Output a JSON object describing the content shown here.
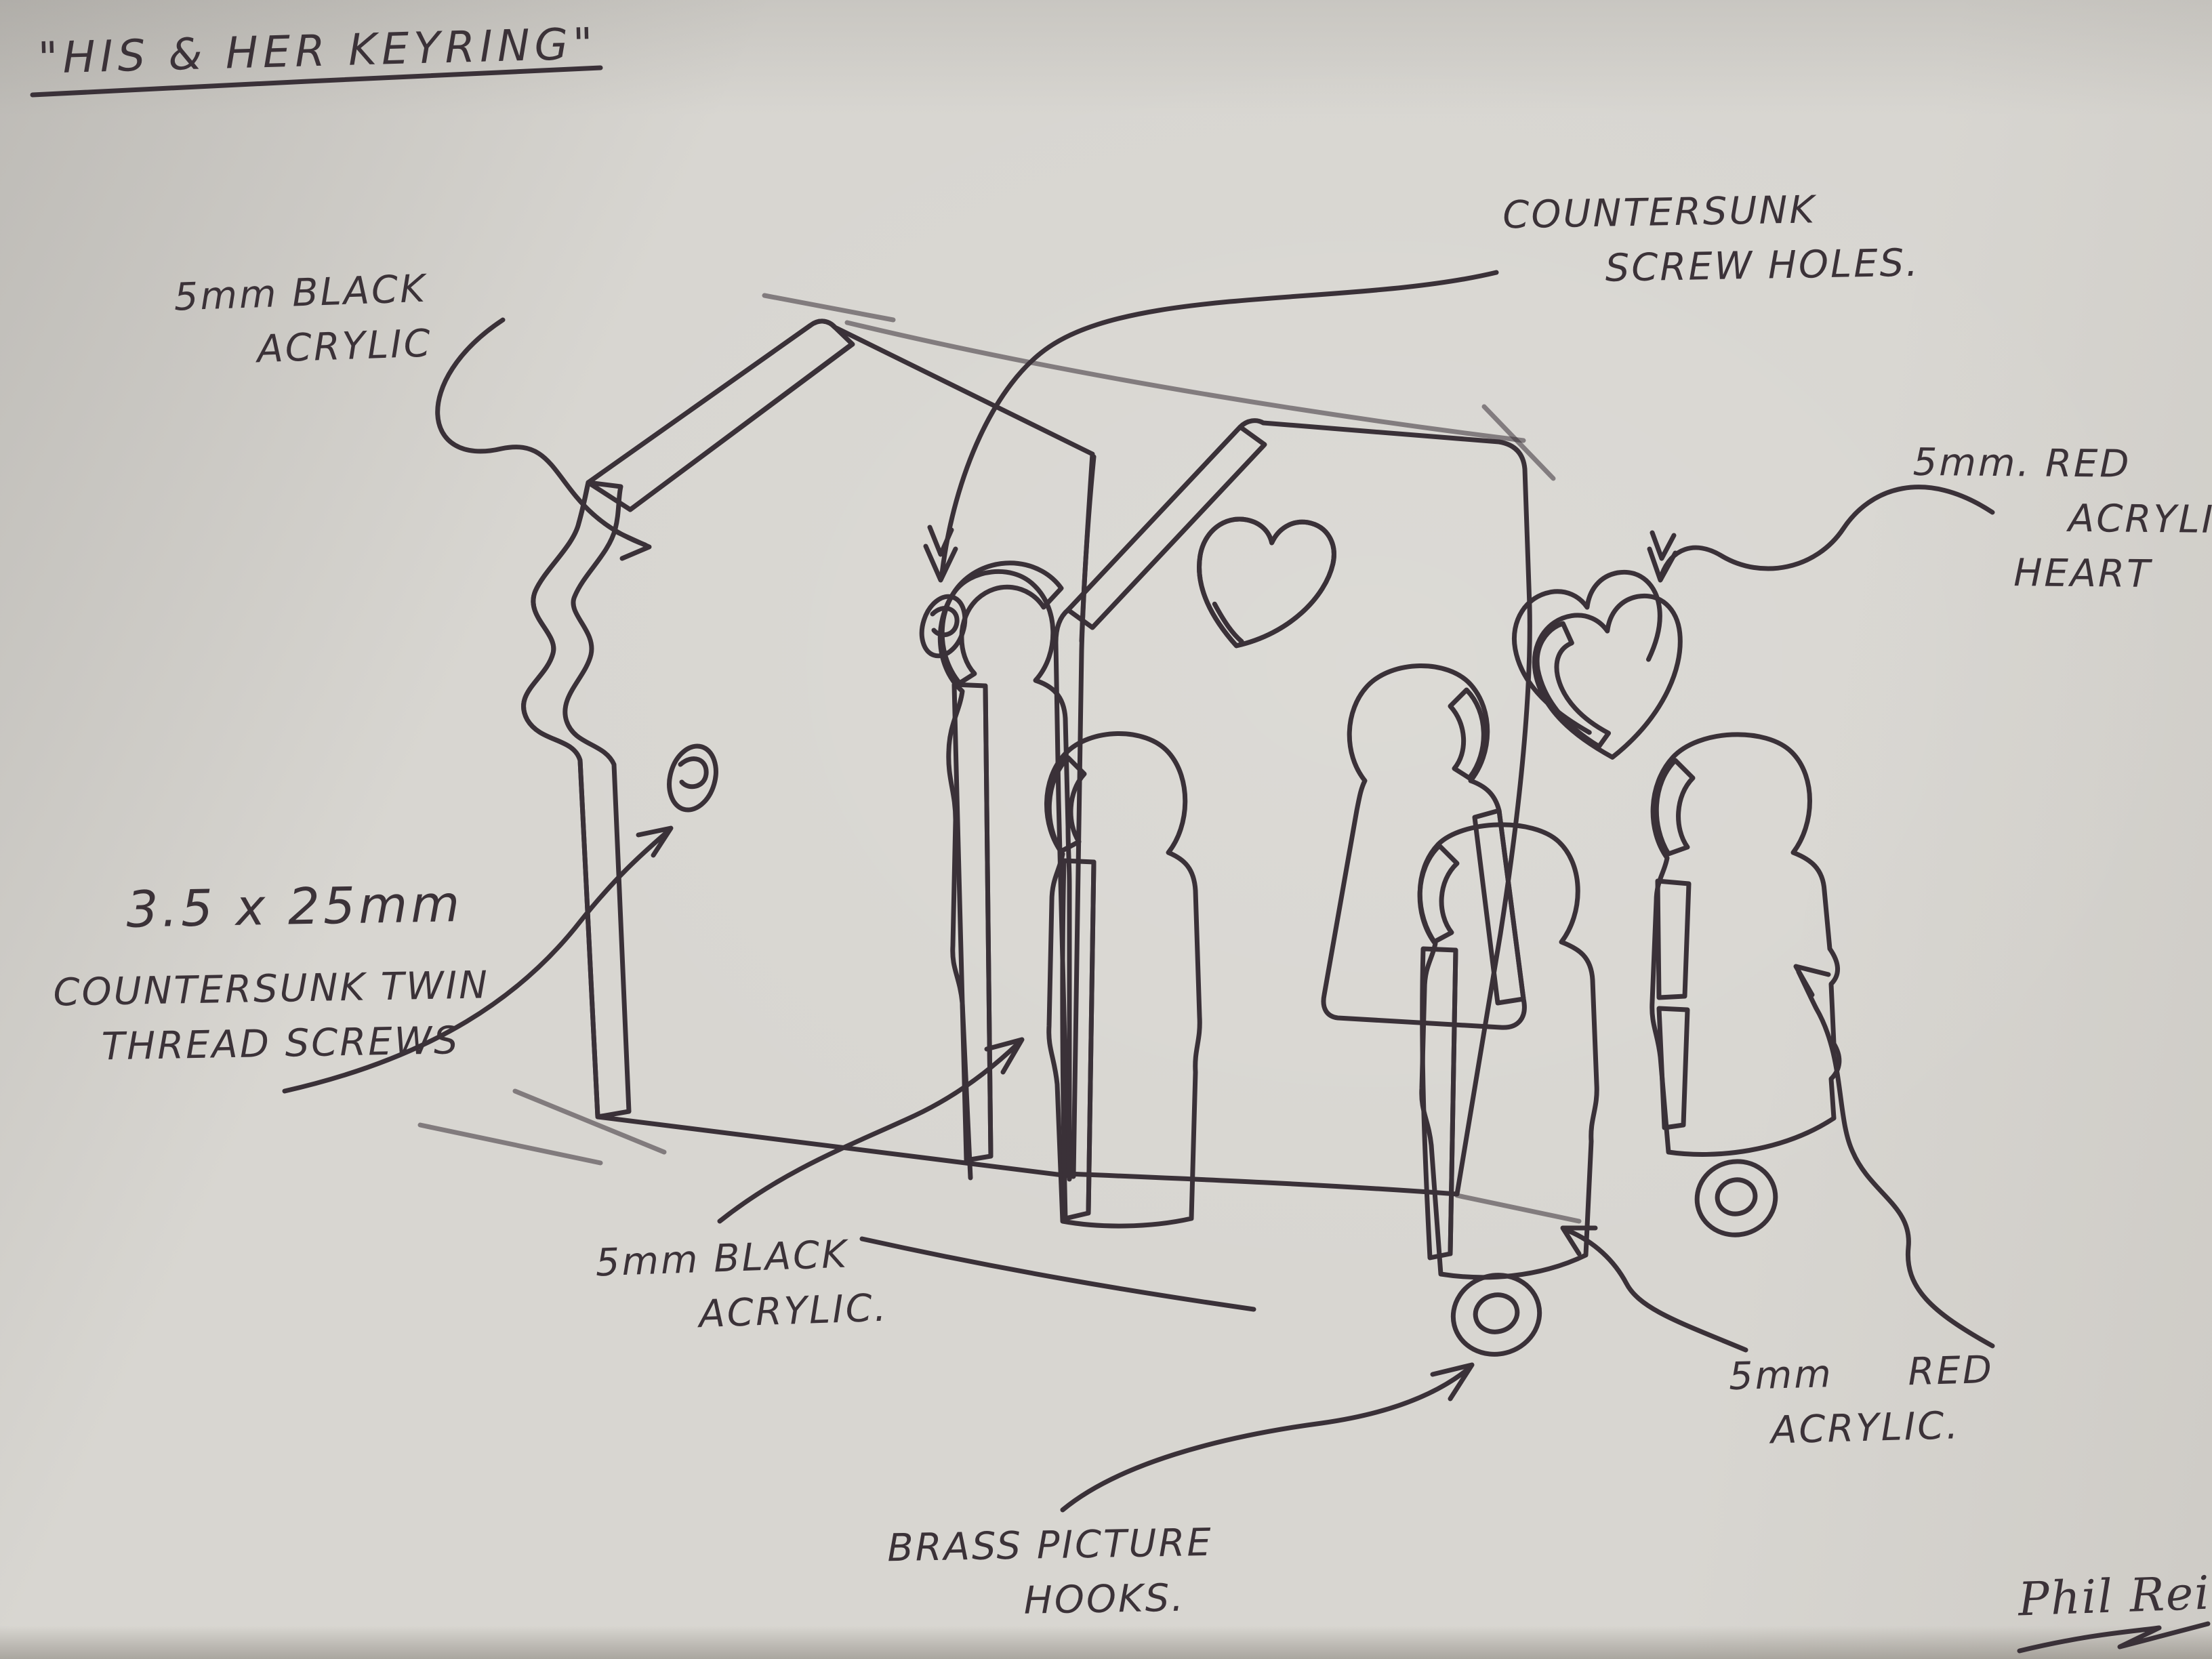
{
  "title": {
    "text": "\"HIS & HER KEYRING\""
  },
  "labels": {
    "black_acrylic_top": {
      "lines": [
        "5mm BLACK",
        "ACRYLIC"
      ]
    },
    "countersunk_holes": {
      "lines": [
        "COUNTERSUNK",
        "SCREW HOLES."
      ]
    },
    "red_acrylic_heart": {
      "lines": [
        "5mm. RED",
        "ACRYLIC",
        "HEART"
      ]
    },
    "countersunk_screws": {
      "lines": [
        "3.5 x 25mm",
        "COUNTERSUNK TWIN",
        "THREAD SCREWS"
      ]
    },
    "black_acrylic_bottom": {
      "lines": [
        "5mm BLACK",
        "ACRYLIC."
      ]
    },
    "brass_hooks": {
      "lines": [
        "BRASS PICTURE",
        "HOOKS."
      ]
    },
    "red_acrylic_keyrings": {
      "lines": [
        "5mm RED",
        "ACRYLIC."
      ]
    }
  },
  "signature": {
    "text": "Phil Reilly"
  },
  "drawing": {
    "ink_color": "#3a3138",
    "paper_color": "#d8d6d1",
    "parts": [
      "back-house-panel",
      "front-house-panel",
      "man-cutout",
      "heart-cutout",
      "woman-cutout",
      "man-keyring-piece",
      "his-keyring-figure",
      "her-keyring-figure",
      "red-heart-piece",
      "screw-hole-left",
      "screw-hole-top",
      "hook-rings"
    ]
  }
}
